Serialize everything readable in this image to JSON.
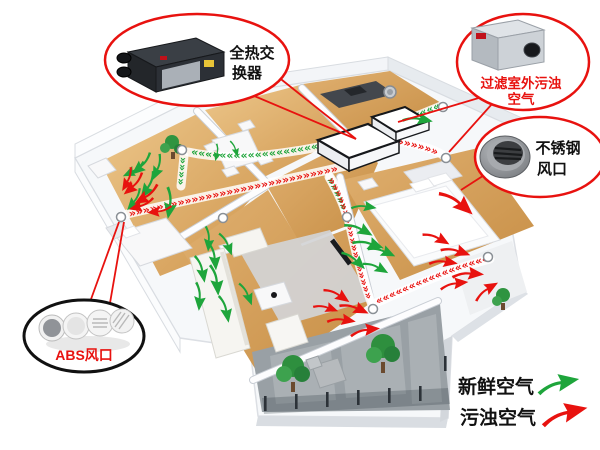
{
  "callouts": {
    "heat_exchanger": {
      "label": "全热交换器",
      "lines": [
        "全热交",
        "换器"
      ]
    },
    "filter": {
      "label": "过滤室外污浊空气",
      "lines": [
        "过滤室外污浊",
        "空气"
      ]
    },
    "stainless_vent": {
      "label": "不锈钢风口",
      "lines": [
        "不锈钢",
        "风口"
      ]
    },
    "abs_vent": {
      "label": "ABS风口"
    }
  },
  "legend": {
    "fresh_label": "新鲜空气",
    "dirty_label": "污浊空气"
  },
  "ducts": {
    "g1": "»»»»»»»»»»»»»»»»»»»»",
    "g2": "»»»»",
    "g4": "»»»»»",
    "g5": "»»»»»",
    "r1": "»»»»»»»»»»»»»»»»»»»»»»»»»»»»»»",
    "r2": "»»»»»»»",
    "r3": "»»»»»»»»»»»»»»»»»»",
    "r4": "»»»»»»»»»»»»»»»»»»»»"
  },
  "colors": {
    "fresh": "#1ea53b",
    "dirty": "#e8120f",
    "callout_red": "#e8120f",
    "ink": "#111111",
    "wood": "#d9a45c",
    "wall": "#f6f8fa",
    "rug": "#d2d3d5",
    "balcony": "#99a0a5"
  },
  "icons": {
    "heat-exchanger-unit": "black HRV box with round duct ports",
    "filter-unit": "silver inline filter box with round port",
    "stainless-vent": "round stainless-steel louvered vent",
    "abs-vent": "round white ABS vents",
    "fresh-arrow": "green swoosh arrow",
    "dirty-arrow": "red swoosh arrow",
    "duct-chevron": "»"
  }
}
